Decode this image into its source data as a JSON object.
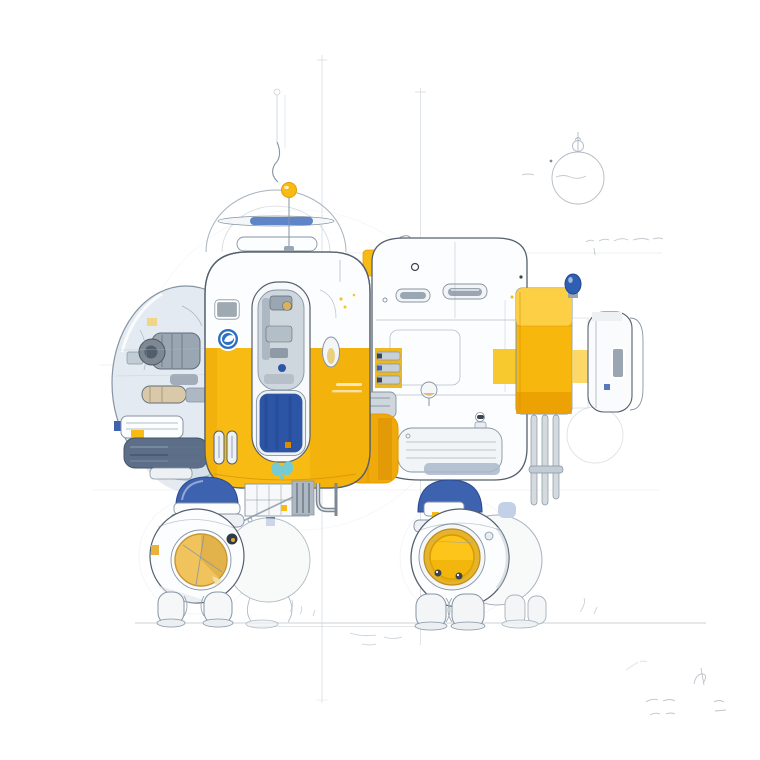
{
  "artwork": {
    "title": "Robot pod concept sketch",
    "medium": "watercolor and pencil technical illustration on white paper",
    "subject": "four-legged robotic pod vehicle with glass cockpit bubble, central door module, rear equipment module and thruster block",
    "aria_label": "Technical watercolor sketch of a white, yellow and blue four-legged robot pod standing on a faint ground line"
  },
  "colors": {
    "paper": "#ffffff",
    "ink": "#55606d",
    "ink_soft": "#8694a3",
    "pencil": "#b6c0ca",
    "pencil_dark": "#98a4b0",
    "white_body": "#fcfdfe",
    "panel": "#eef1f4",
    "glass": "#e3eaf1",
    "glass_deep": "#cdd9e3",
    "metal": "#9aa6b2",
    "metal_dark": "#5f6c7a",
    "yellow": "#f8bb13",
    "yellow_deep": "#e89c00",
    "yellow_pale": "#fcd14b",
    "amber": "#f0a90a",
    "blue_window": "#2c55a6",
    "blue_window_dark": "#23448c",
    "blue_cap": "#3c62b0",
    "blue_cap_dark": "#2c4c94",
    "blue_badge": "#2e6fc2",
    "blue_bulb": "#2f5fb3",
    "teal": "#74cbd4",
    "porthole_left": "#f1c35d",
    "porthole_right": "#fdc41a",
    "porthole_ring": "#d99a00",
    "underside": "#5d6f88",
    "ground_line": "#ccd3d9"
  },
  "notes": {
    "top_right": "illegible pencil sketch: small sphere with antenna and faint notes",
    "mid_right": "illegible pencil annotation line",
    "bottom_right": "illegible pencil scribbles / signature marks"
  }
}
